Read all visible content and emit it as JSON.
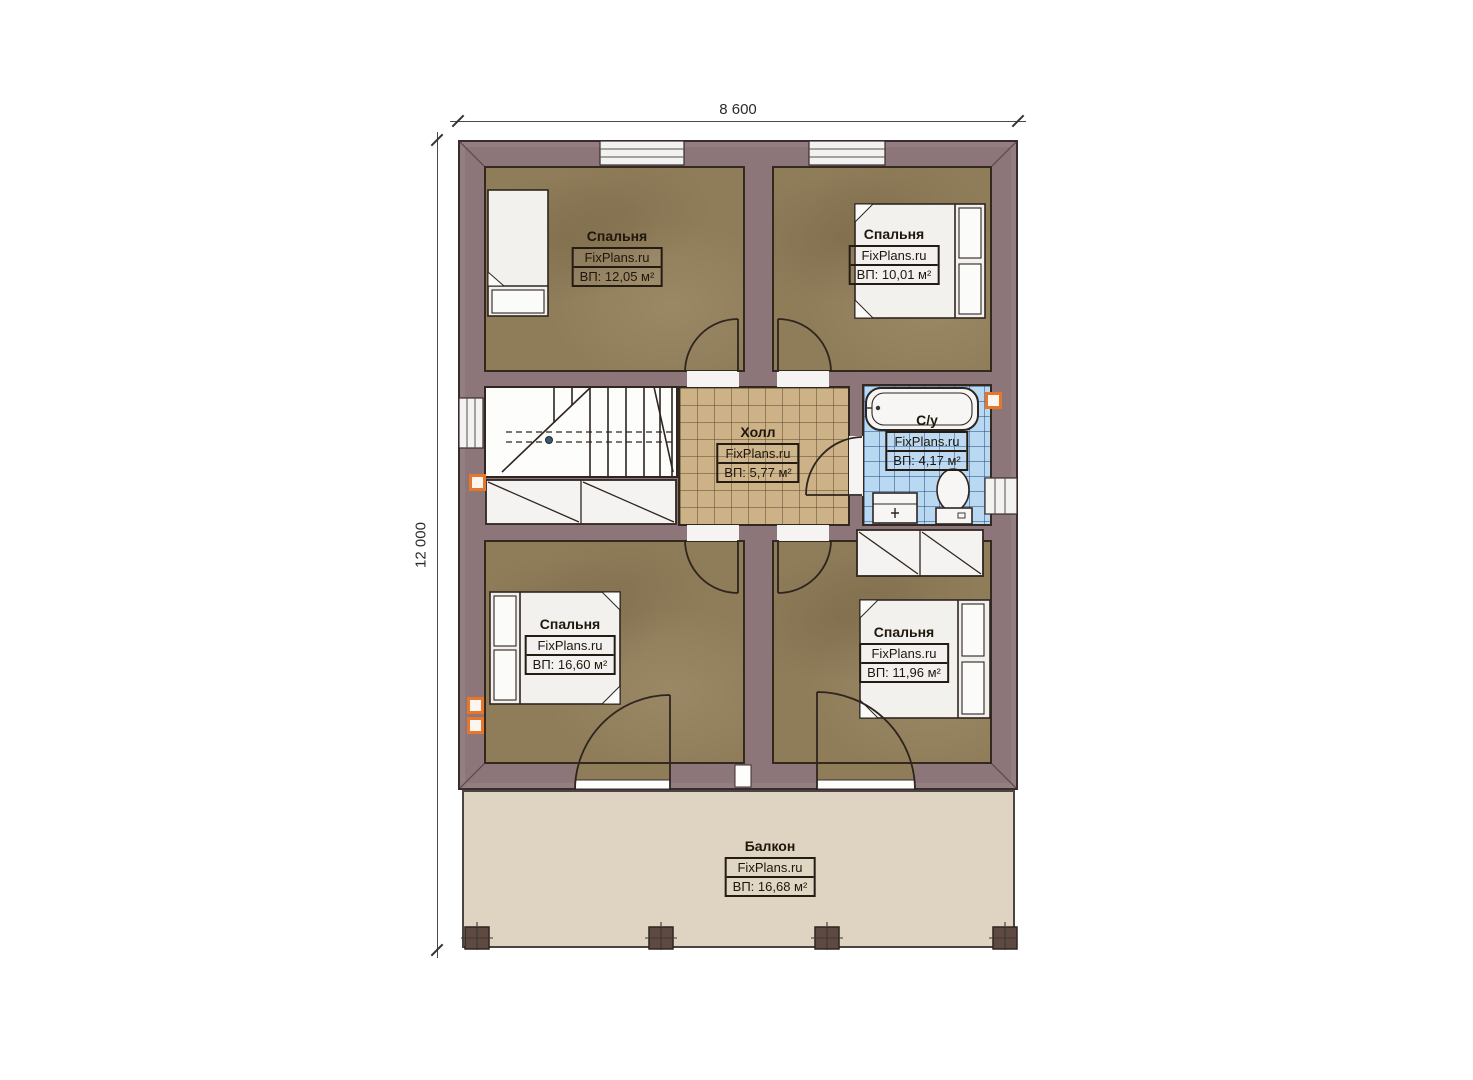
{
  "plan": {
    "dimensions": {
      "width_label": "8 600",
      "depth_label": "12 000"
    },
    "rooms": [
      {
        "id": "bedroom-top-left",
        "name": "Спальня",
        "watermark": "FixPlans.ru",
        "area": "ВП: 12,05 м²"
      },
      {
        "id": "bedroom-top-right",
        "name": "Спальня",
        "watermark": "FixPlans.ru",
        "area": "ВП: 10,01 м²"
      },
      {
        "id": "hall",
        "name": "Холл",
        "watermark": "FixPlans.ru",
        "area": "ВП: 5,77 м²"
      },
      {
        "id": "bathroom",
        "name": "С/у",
        "watermark": "FixPlans.ru",
        "area": "ВП: 4,17 м²"
      },
      {
        "id": "bedroom-bottom-left",
        "name": "Спальня",
        "watermark": "FixPlans.ru",
        "area": "ВП: 16,60 м²"
      },
      {
        "id": "bedroom-bottom-right",
        "name": "Спальня",
        "watermark": "FixPlans.ru",
        "area": "ВП: 11,96 м²"
      },
      {
        "id": "balcony",
        "name": "Балкон",
        "watermark": "FixPlans.ru",
        "area": "ВП: 16,68 м²"
      }
    ],
    "colors": {
      "wall": "#8d767a",
      "bedroom_floor": "#8f7c59",
      "hall_floor": "#ccb286",
      "bathroom_floor": "#b9d8f2",
      "balcony_floor": "#ded4c1",
      "outline": "#3a2c2e",
      "marker_orange": "#e8762a"
    }
  }
}
